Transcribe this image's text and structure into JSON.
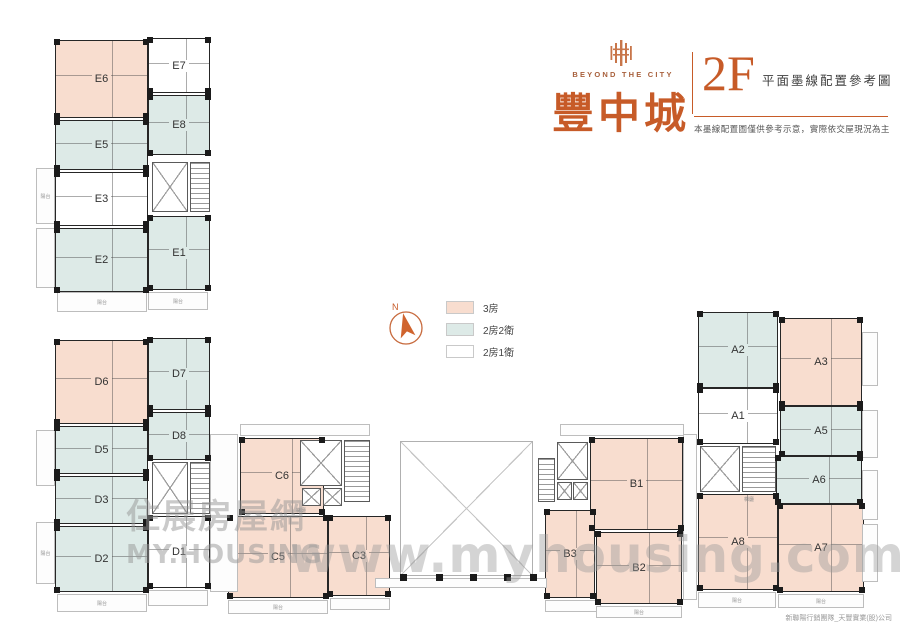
{
  "brand": {
    "logo_en": "BEYOND THE CITY",
    "logo_zh": "豐中城",
    "floor": "2F",
    "plan_title": "平面墨線配置參考圖",
    "disclaimer": "本墨線配置圖僅供參考示意，實際依交屋現況為主",
    "brand_color": "#c75b28"
  },
  "legend": {
    "compass_label": "N",
    "items": [
      {
        "label": "3房",
        "color": "#f8ddcf"
      },
      {
        "label": "2房2衛",
        "color": "#ddeae7"
      },
      {
        "label": "2房1衛",
        "color": "#ffffff"
      }
    ]
  },
  "watermark": {
    "logo_cjk": "住展房屋網",
    "logo_en": "MY.HOUSING",
    "url": "www.myhousing.com.tw"
  },
  "credit": "新聯陽行銷團隊_天豐實業(股)公司",
  "plan": {
    "balcony_label": "陽台",
    "units": [
      {
        "id": "E6",
        "t": "t3",
        "x": 55,
        "y": 40,
        "w": 93,
        "h": 78
      },
      {
        "id": "E7",
        "t": "t21",
        "x": 148,
        "y": 38,
        "w": 62,
        "h": 55
      },
      {
        "id": "E8",
        "t": "t22",
        "x": 148,
        "y": 95,
        "w": 62,
        "h": 60
      },
      {
        "id": "E5",
        "t": "t22",
        "x": 55,
        "y": 120,
        "w": 93,
        "h": 50
      },
      {
        "id": "E3",
        "t": "t21",
        "x": 55,
        "y": 172,
        "w": 93,
        "h": 54
      },
      {
        "id": "E1",
        "t": "t22",
        "x": 148,
        "y": 216,
        "w": 62,
        "h": 74
      },
      {
        "id": "E2",
        "t": "t22",
        "x": 55,
        "y": 228,
        "w": 93,
        "h": 64
      },
      {
        "id": "D6",
        "t": "t3",
        "x": 55,
        "y": 340,
        "w": 93,
        "h": 84
      },
      {
        "id": "D7",
        "t": "t22",
        "x": 148,
        "y": 338,
        "w": 62,
        "h": 72
      },
      {
        "id": "D5",
        "t": "t22",
        "x": 55,
        "y": 426,
        "w": 93,
        "h": 48
      },
      {
        "id": "D8",
        "t": "t22",
        "x": 148,
        "y": 412,
        "w": 62,
        "h": 48
      },
      {
        "id": "D3",
        "t": "t22",
        "x": 55,
        "y": 476,
        "w": 93,
        "h": 48
      },
      {
        "id": "D2",
        "t": "t22",
        "x": 55,
        "y": 526,
        "w": 93,
        "h": 66
      },
      {
        "id": "D1",
        "t": "t21",
        "x": 148,
        "y": 516,
        "w": 62,
        "h": 72
      },
      {
        "id": "C6",
        "t": "t3",
        "x": 240,
        "y": 438,
        "w": 84,
        "h": 76
      },
      {
        "id": "C5",
        "t": "t3",
        "x": 228,
        "y": 516,
        "w": 100,
        "h": 82
      },
      {
        "id": "C3",
        "t": "t3",
        "x": 328,
        "y": 516,
        "w": 62,
        "h": 80
      },
      {
        "id": "B1",
        "t": "t3",
        "x": 590,
        "y": 438,
        "w": 93,
        "h": 92
      },
      {
        "id": "B3",
        "t": "t3",
        "x": 545,
        "y": 510,
        "w": 50,
        "h": 88
      },
      {
        "id": "B2",
        "t": "t3",
        "x": 596,
        "y": 532,
        "w": 86,
        "h": 72
      },
      {
        "id": "A2",
        "t": "t22",
        "x": 698,
        "y": 312,
        "w": 80,
        "h": 76
      },
      {
        "id": "A3",
        "t": "t3",
        "x": 780,
        "y": 318,
        "w": 82,
        "h": 88
      },
      {
        "id": "A1",
        "t": "t21",
        "x": 698,
        "y": 388,
        "w": 80,
        "h": 56
      },
      {
        "id": "A5",
        "t": "t22",
        "x": 780,
        "y": 406,
        "w": 82,
        "h": 50
      },
      {
        "id": "A6",
        "t": "t22",
        "x": 776,
        "y": 456,
        "w": 86,
        "h": 48
      },
      {
        "id": "A8",
        "t": "t3",
        "x": 698,
        "y": 494,
        "w": 80,
        "h": 96
      },
      {
        "id": "A7",
        "t": "t3",
        "x": 778,
        "y": 504,
        "w": 86,
        "h": 88
      }
    ],
    "cores": [
      {
        "x": 152,
        "y": 162,
        "w": 36,
        "h": 50,
        "k": "x"
      },
      {
        "x": 190,
        "y": 162,
        "w": 20,
        "h": 50,
        "k": "stairs"
      },
      {
        "x": 152,
        "y": 462,
        "w": 36,
        "h": 52,
        "k": "x"
      },
      {
        "x": 190,
        "y": 462,
        "w": 20,
        "h": 52,
        "k": "stairs"
      },
      {
        "x": 300,
        "y": 440,
        "w": 42,
        "h": 46,
        "k": "x"
      },
      {
        "x": 344,
        "y": 440,
        "w": 26,
        "h": 62,
        "k": "stairs"
      },
      {
        "x": 302,
        "y": 488,
        "w": 19,
        "h": 18,
        "k": "x"
      },
      {
        "x": 323,
        "y": 488,
        "w": 19,
        "h": 18,
        "k": "x"
      },
      {
        "x": 400,
        "y": 441,
        "w": 133,
        "h": 135,
        "k": "open"
      },
      {
        "x": 538,
        "y": 458,
        "w": 17,
        "h": 44,
        "k": "stairs"
      },
      {
        "x": 557,
        "y": 442,
        "w": 31,
        "h": 38,
        "k": "x"
      },
      {
        "x": 557,
        "y": 482,
        "w": 15,
        "h": 18,
        "k": "x"
      },
      {
        "x": 573,
        "y": 482,
        "w": 15,
        "h": 18,
        "k": "x"
      },
      {
        "x": 700,
        "y": 446,
        "w": 40,
        "h": 46,
        "k": "x"
      },
      {
        "x": 742,
        "y": 446,
        "w": 34,
        "h": 46,
        "k": "stairs"
      }
    ],
    "outlines": [
      {
        "x": 36,
        "y": 168,
        "w": 19,
        "h": 56,
        "label": "陽台"
      },
      {
        "x": 36,
        "y": 228,
        "w": 19,
        "h": 60,
        "label": ""
      },
      {
        "x": 57,
        "y": 292,
        "w": 90,
        "h": 20,
        "label": "陽台"
      },
      {
        "x": 148,
        "y": 292,
        "w": 60,
        "h": 18,
        "label": "陽台"
      },
      {
        "x": 36,
        "y": 430,
        "w": 19,
        "h": 56,
        "label": ""
      },
      {
        "x": 36,
        "y": 522,
        "w": 19,
        "h": 62,
        "label": "陽台"
      },
      {
        "x": 57,
        "y": 594,
        "w": 90,
        "h": 18,
        "label": "陽台"
      },
      {
        "x": 148,
        "y": 590,
        "w": 60,
        "h": 16,
        "label": ""
      },
      {
        "x": 210,
        "y": 434,
        "w": 28,
        "h": 158,
        "label": ""
      },
      {
        "x": 228,
        "y": 600,
        "w": 100,
        "h": 14,
        "label": "陽台"
      },
      {
        "x": 330,
        "y": 598,
        "w": 60,
        "h": 12,
        "label": ""
      },
      {
        "x": 240,
        "y": 424,
        "w": 130,
        "h": 12,
        "label": ""
      },
      {
        "x": 560,
        "y": 424,
        "w": 124,
        "h": 12,
        "label": ""
      },
      {
        "x": 545,
        "y": 600,
        "w": 56,
        "h": 12,
        "label": ""
      },
      {
        "x": 596,
        "y": 606,
        "w": 86,
        "h": 12,
        "label": "陽台"
      },
      {
        "x": 683,
        "y": 434,
        "w": 14,
        "h": 166,
        "label": ""
      },
      {
        "x": 862,
        "y": 332,
        "w": 16,
        "h": 54,
        "label": ""
      },
      {
        "x": 862,
        "y": 410,
        "w": 16,
        "h": 48,
        "label": ""
      },
      {
        "x": 862,
        "y": 470,
        "w": 16,
        "h": 50,
        "label": ""
      },
      {
        "x": 862,
        "y": 524,
        "w": 16,
        "h": 58,
        "label": ""
      },
      {
        "x": 698,
        "y": 592,
        "w": 78,
        "h": 16,
        "label": "陽台"
      },
      {
        "x": 778,
        "y": 594,
        "w": 86,
        "h": 14,
        "label": "陽台"
      },
      {
        "x": 375,
        "y": 578,
        "w": 172,
        "h": 10,
        "label": ""
      }
    ],
    "pillars": [
      [
        400,
        574
      ],
      [
        436,
        574
      ],
      [
        470,
        574
      ],
      [
        504,
        574
      ],
      [
        530,
        574
      ]
    ],
    "tiny_labels": [
      {
        "text": "梯廳",
        "x": 296,
        "y": 507
      },
      {
        "text": "梯廳",
        "x": 744,
        "y": 496
      }
    ]
  }
}
